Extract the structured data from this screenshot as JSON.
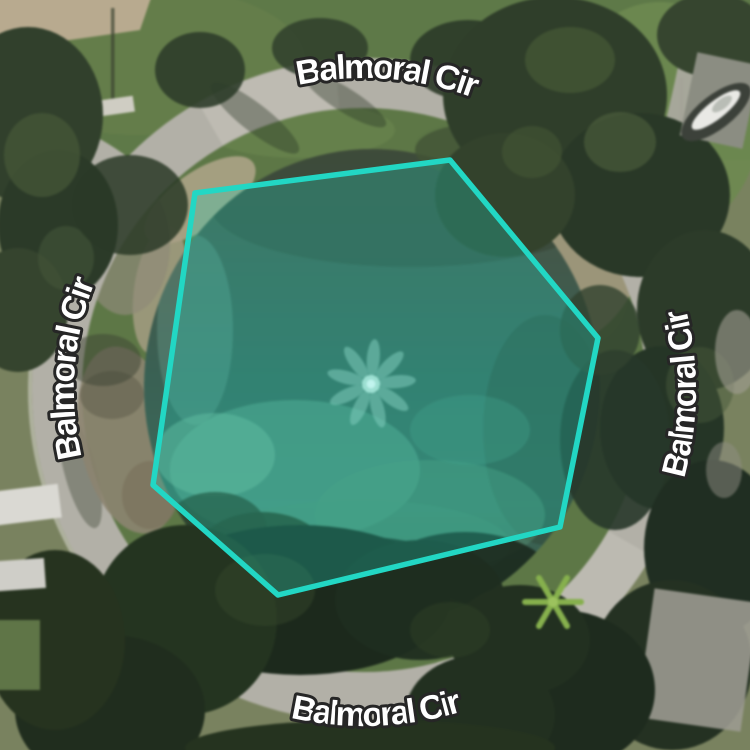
{
  "map": {
    "view_type": "satellite",
    "street_labels": [
      {
        "id": "top",
        "text": "Balmoral Cir"
      },
      {
        "id": "left",
        "text": "Balmoral Cir"
      },
      {
        "id": "right",
        "text": "Balmoral Cir"
      },
      {
        "id": "bottom",
        "text": "Balmoral Cir"
      }
    ],
    "label_style": {
      "text_color": "#ffffff",
      "outline_color": "#262626"
    },
    "selection_polygon": {
      "points": "195,193 450,160 598,338 560,527 278,595 153,485",
      "stroke_color": "#22d7c4",
      "fill_color": "#1fd6c3",
      "fill_opacity": 0.28,
      "stroke_width": 5.5
    }
  }
}
